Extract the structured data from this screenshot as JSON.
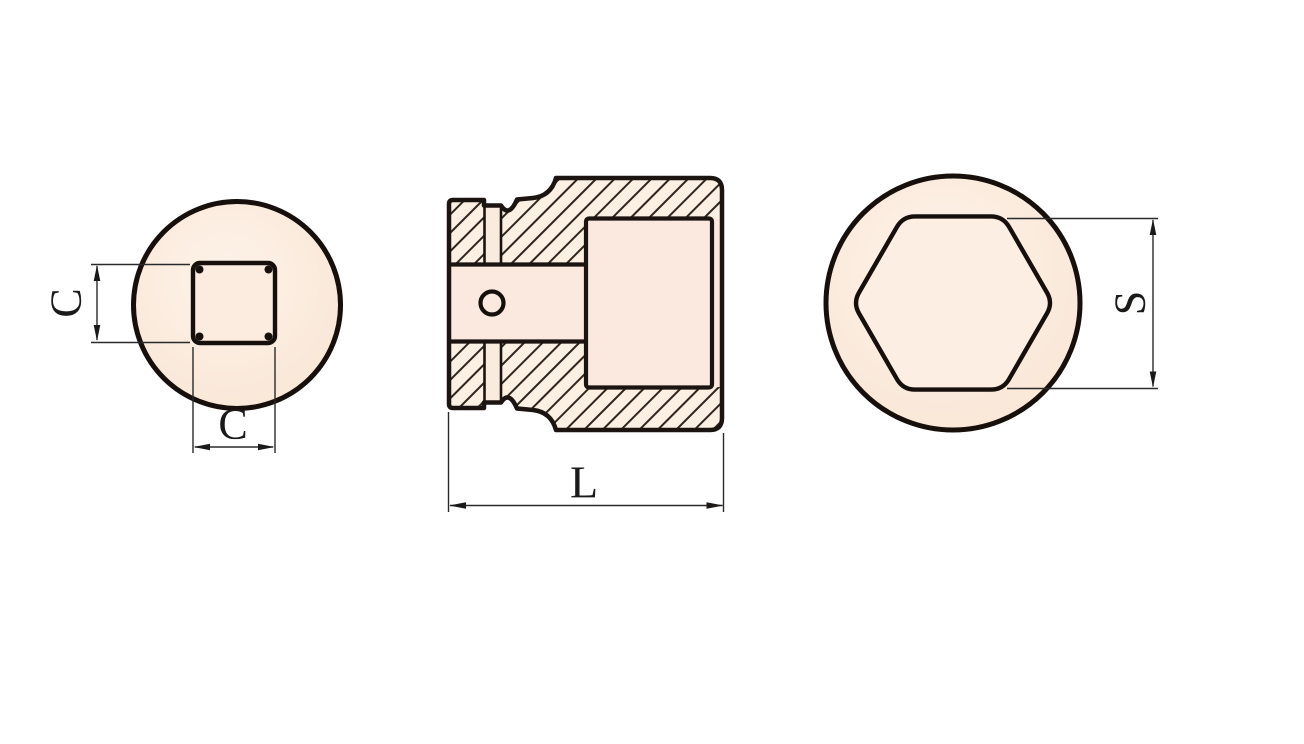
{
  "title": "Impact socket technical drawing - three orthographic views",
  "dims": {
    "square_height": "C",
    "square_width": "C",
    "overall_length": "L",
    "hex_across_flats": "S"
  },
  "views": {
    "left": "square-drive-end-view",
    "middle": "cross-section-side-view",
    "right": "hex-socket-end-view"
  },
  "colors": {
    "background": "#ffffff",
    "outline": "#1b1410",
    "dimension_line": "#2a2a2a",
    "hatch_line": "#2e261e",
    "body_cream": "#fbf0e2",
    "recess_pink": "#fbe9e0",
    "face_peach_light": "#fdf3e9",
    "face_peach_dark": "#f8e4d3"
  }
}
